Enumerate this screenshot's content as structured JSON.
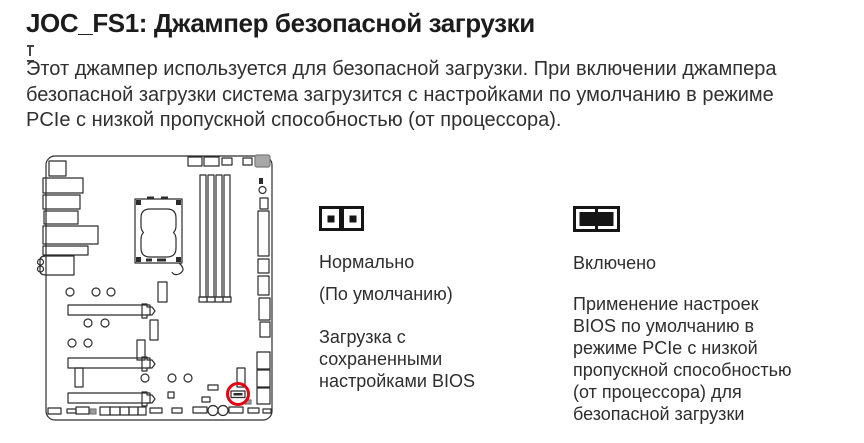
{
  "page": {
    "title": "JOC_FS1: Джампер безопасной загрузки",
    "intro_lines": [
      "Этот джампер используется для безопасной загрузки. При включении джампера",
      "безопасной загрузки система загрузится с настройками по умолчанию в режиме",
      "PCIe с низкой пропускной способностью (от процессора)."
    ]
  },
  "diagram": {
    "label": "motherboard-layout",
    "jumper_highlight_color": "#e60012",
    "line_color": "#2c2c2c"
  },
  "options": [
    {
      "icon": "jumper-open",
      "label": "Нормально",
      "sublabel": "(По умолчанию)",
      "description_lines": [
        "Загрузка с",
        "сохраненными",
        "настройками BIOS"
      ]
    },
    {
      "icon": "jumper-closed",
      "label": "Включено",
      "description_lines": [
        "Применение настроек",
        "BIOS по умолчанию в",
        "режиме PCIe с низкой",
        "пропускной способностью",
        "(от процессора) для",
        "безопасной загрузки"
      ]
    }
  ]
}
